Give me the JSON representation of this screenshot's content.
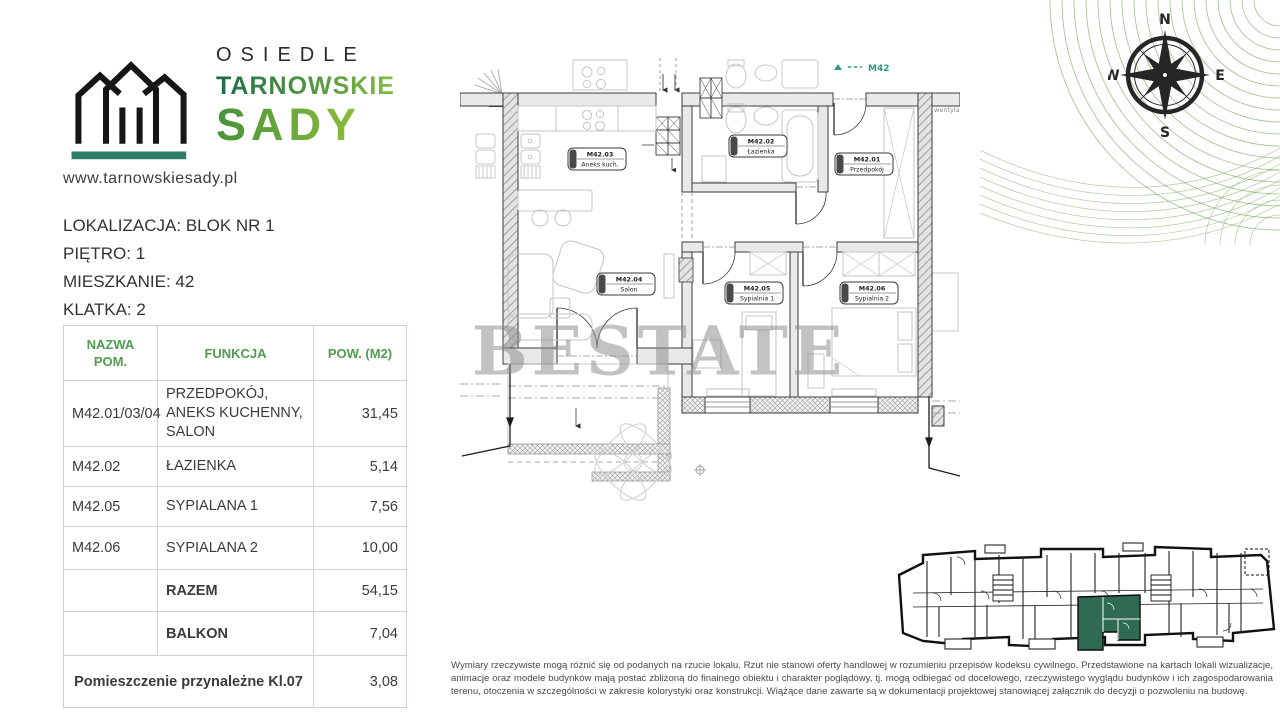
{
  "brand": {
    "line1": "OSIEDLE",
    "line2": "TARNOWSKIE",
    "line3": "SADY",
    "website": "www.tarnowskiesady.pl",
    "accent_teal": "#2e7d68",
    "green_dark": "#1d6b47",
    "green_light": "#8fc63f"
  },
  "location": {
    "line1": "LOKALIZACJA: BLOK NR 1",
    "line2": "PIĘTRO: 1",
    "line3": "MIESZKANIE: 42",
    "line4": "KLATKA: 2"
  },
  "table": {
    "headers": [
      "NAZWA POM.",
      "FUNKCJA",
      "POW. (M2)"
    ],
    "header_color": "#4f9d4f",
    "rows": [
      {
        "name": "M42.01/03/04",
        "function": "PRZEDPOKÓJ, ANEKS KUCHENNY, SALON",
        "area": "31,45"
      },
      {
        "name": "M42.02",
        "function": "ŁAZIENKA",
        "area": "5,14"
      },
      {
        "name": "M42.05",
        "function": "SYPIALANA 1",
        "area": "7,56"
      },
      {
        "name": "M42.06",
        "function": "SYPIALANA 2",
        "area": "10,00"
      }
    ],
    "summary": [
      {
        "label": "RAZEM",
        "value": "54,15"
      },
      {
        "label": "BALKON",
        "value": "7,04"
      }
    ],
    "footer": {
      "label": "Pomieszczenie przynależne Kl.07",
      "value": "3,08"
    }
  },
  "plan": {
    "unit_tag": "M42",
    "vent_label": "wentylac",
    "watermark": "BESTATE",
    "rooms": [
      {
        "id": "M42.03",
        "name": "Aneks kuch."
      },
      {
        "id": "M42.02",
        "name": "Łazienka"
      },
      {
        "id": "M42.01",
        "name": "Przedpokój"
      },
      {
        "id": "M42.04",
        "name": "Salon"
      },
      {
        "id": "M42.05",
        "name": "Sypialnia 1"
      },
      {
        "id": "M42.06",
        "name": "Sypialnia 2"
      }
    ]
  },
  "compass": {
    "n": "N",
    "e": "E",
    "s": "S",
    "w": "W"
  },
  "mini_plan": {
    "highlight_color": "#2e6b52"
  },
  "disclaimer": "Wymiary rzeczywiste mogą różnić się od podanych na rzucie lokalu. Rzut nie stanowi oferty handlowej w rozumieniu przepisów kodeksu cywilnego. Przedstawione na kartach lokali wizualizacje, animacje oraz modele budynków mają postać zbliżoną do finalnego obiektu i charakter poglądowy, tj. mogą odbiegać od docelowego, rzeczywistego wyglądu budynków i ich zagospodarowania terenu, otoczenia w szczególności w zakresie kolorystyki oraz konstrukcji. Wiążące dane zawarte są w dokumentacji projektowej stanowiącej załącznik do decyzji o pozwoleniu na budowę."
}
